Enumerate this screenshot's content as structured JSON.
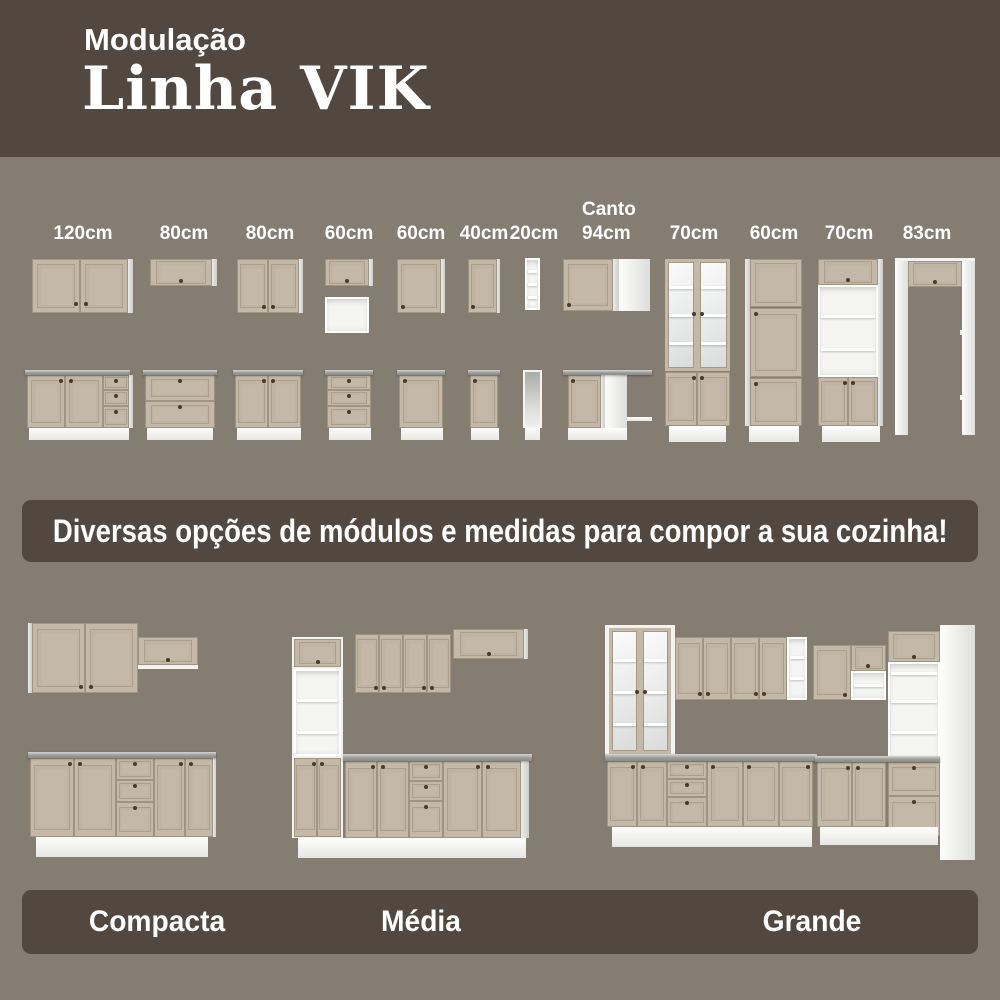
{
  "header": {
    "subtitle": "Modulação",
    "title": "Linha VIK"
  },
  "modules": {
    "items": [
      {
        "label": "120cm"
      },
      {
        "label": "80cm"
      },
      {
        "label": "80cm"
      },
      {
        "label": "60cm"
      },
      {
        "label": "60cm"
      },
      {
        "label": "40cm"
      },
      {
        "label": "20cm"
      },
      {
        "label": "Canto\n94cm"
      },
      {
        "label": "70cm"
      },
      {
        "label": "60cm"
      },
      {
        "label": "70cm"
      },
      {
        "label": "83cm"
      }
    ]
  },
  "banner": {
    "text": "Diversas opções de módulos e medidas para compor a sua cozinha!"
  },
  "kitchen_sizes": [
    {
      "label": "Compacta"
    },
    {
      "label": "Média"
    },
    {
      "label": "Grande"
    }
  ],
  "colors": {
    "background": "#857C72",
    "panel_dark_brown": "#524840",
    "cabinet_beige": "#C4B9A8",
    "carcass_white": "#F3F3F1",
    "countertop_gray": "#9B9B98",
    "text": "#FFFFFF"
  }
}
